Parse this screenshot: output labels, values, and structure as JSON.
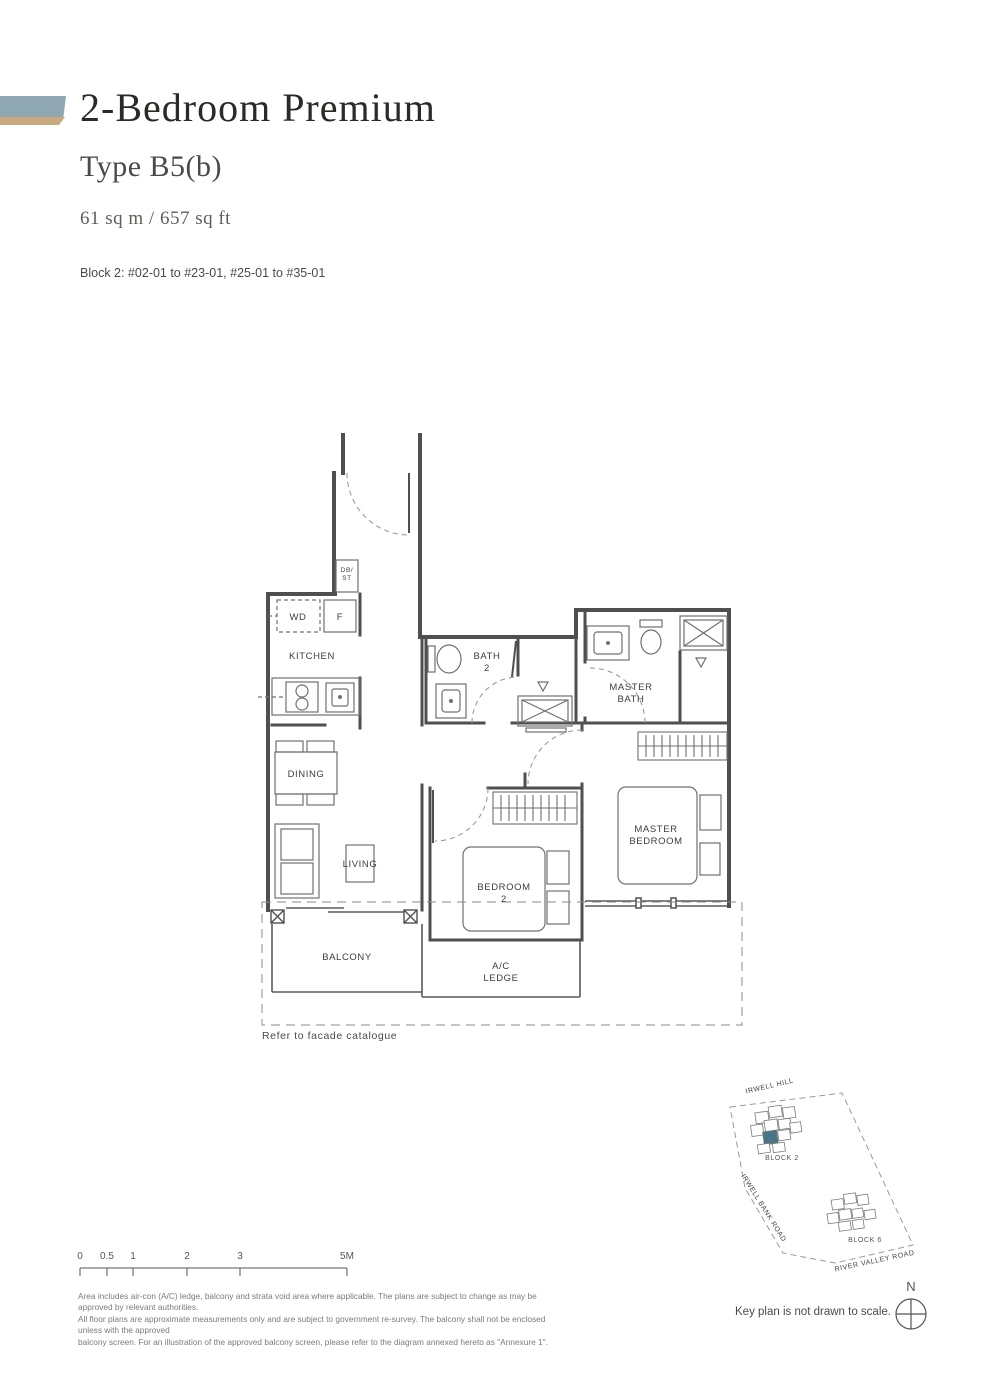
{
  "header": {
    "title": "2-Bedroom Premium",
    "type": "Type B5(b)",
    "area": "61 sq m / 657 sq ft",
    "block_info": "Block 2: #02-01 to #23-01, #25-01 to #35-01"
  },
  "accent": {
    "bar_blue": "#8fa7b3",
    "bar_gold": "#c9a97e"
  },
  "plan_labels": {
    "db1": "DB/",
    "db2": "ST",
    "wd": "WD",
    "f": "F",
    "kitchen": "KITCHEN",
    "dining": "DINING",
    "living": "LIVING",
    "bath2_1": "BATH",
    "bath2_2": "2",
    "mbath_1": "MASTER",
    "mbath_2": "BATH",
    "mbed_1": "MASTER",
    "mbed_2": "BEDROOM",
    "bed2_1": "BEDROOM",
    "bed2_2": "2",
    "balcony": "BALCONY",
    "ac_1": "A/C",
    "ac_2": "LEDGE",
    "facade_note": "Refer to facade catalogue"
  },
  "scale_bar": {
    "ticks": [
      "0",
      "0.5",
      "1",
      "2",
      "3",
      "5M"
    ]
  },
  "key_plan": {
    "road_irwell_hill": "IRWELL HILL",
    "road_irwell_bank": "IRWELL BANK ROAD",
    "road_river_valley": "RIVER VALLEY ROAD",
    "block2": "BLOCK 2",
    "block6": "BLOCK 6",
    "compass_n": "N",
    "note": "Key plan is not drawn to scale.",
    "highlight_color": "#4a7487"
  },
  "disclaimer": {
    "line1": "Area includes air-con (A/C) ledge, balcony and strata void area where applicable. The plans are subject to change as may be approved by relevant authorities.",
    "line2": "All floor plans are approximate measurements only and are subject to government re-survey. The balcony shall not be enclosed unless with the approved",
    "line3": "balcony screen. For an illustration of the approved balcony screen, please refer to the diagram annexed hereto as \"Annexure 1\"."
  }
}
